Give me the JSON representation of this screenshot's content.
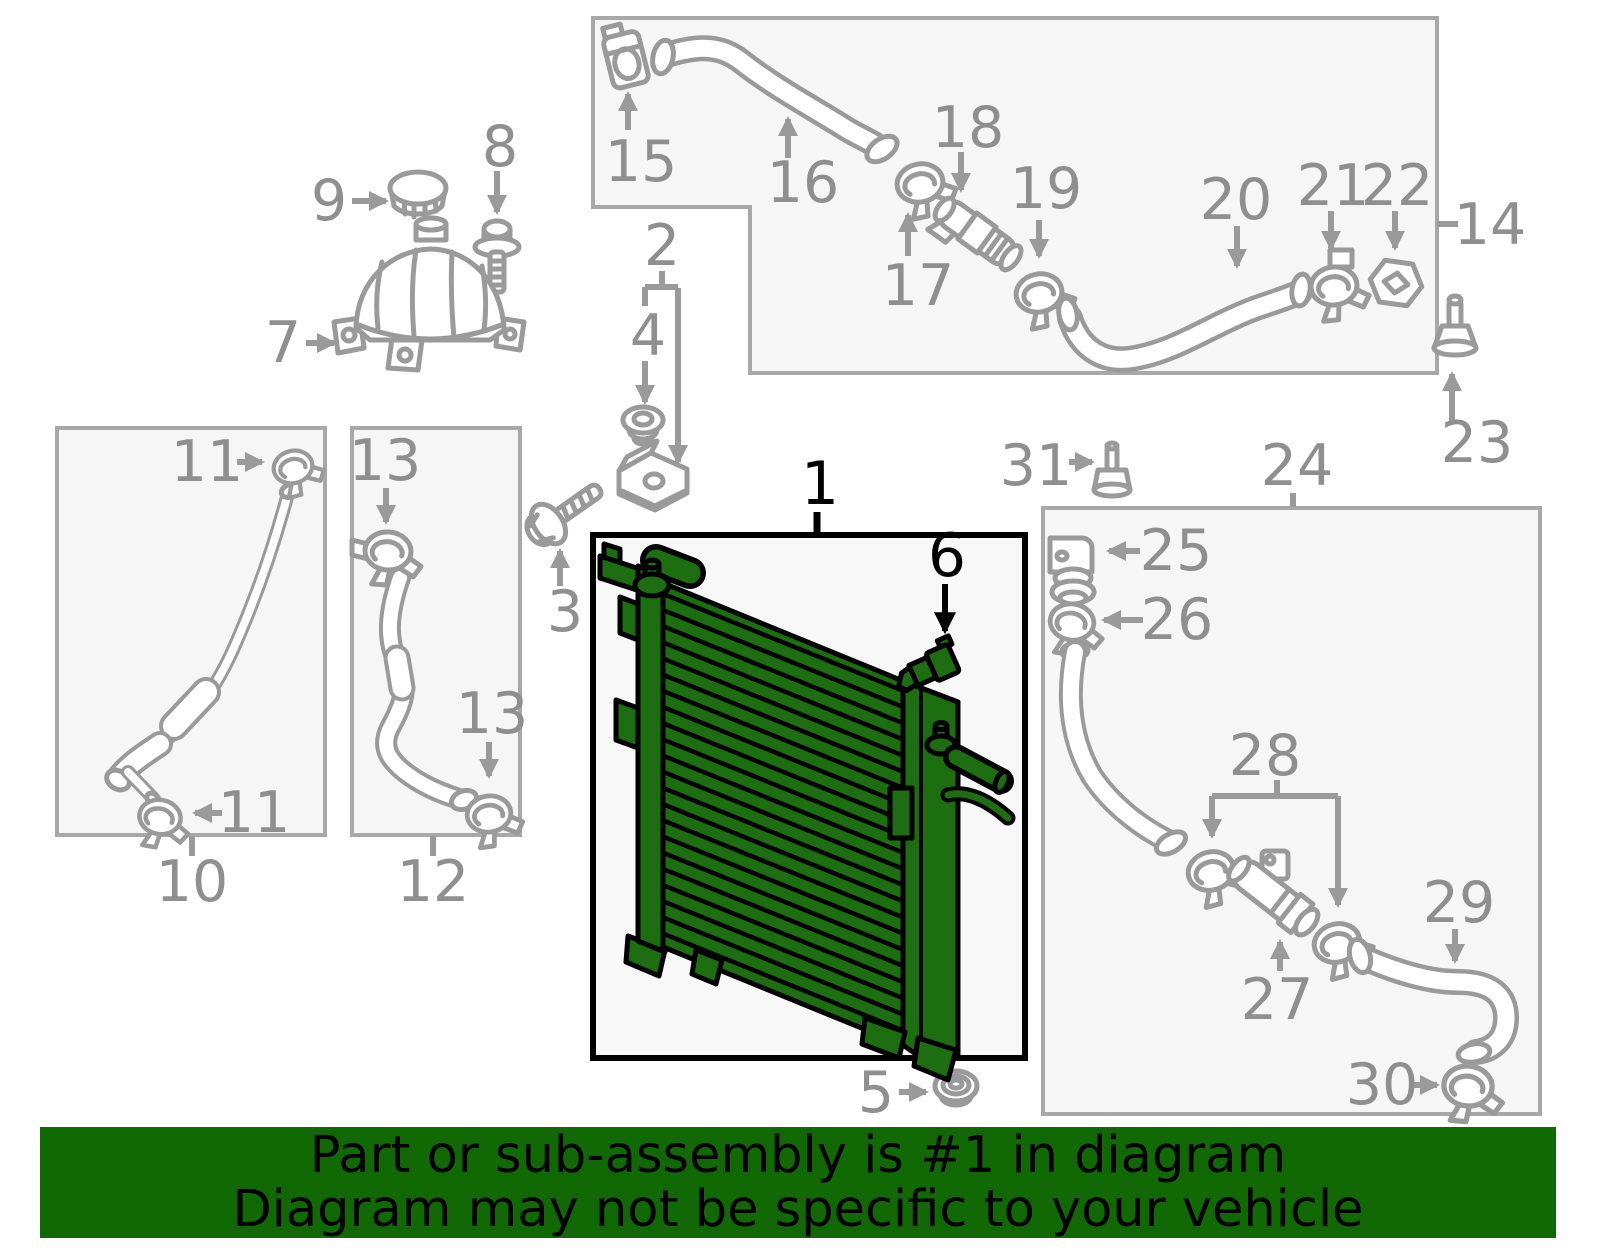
{
  "figure": {
    "kind": "oem-parts-diagram",
    "highlighted_callouts": [
      "1",
      "6"
    ]
  },
  "callouts": {
    "c1": "1",
    "c2": "2",
    "c3": "3",
    "c4": "4",
    "c5": "5",
    "c6": "6",
    "c7": "7",
    "c8": "8",
    "c9": "9",
    "c10": "10",
    "c11": "11",
    "c12": "12",
    "c13": "13",
    "c14": "14",
    "c15": "15",
    "c16": "16",
    "c17": "17",
    "c18": "18",
    "c19": "19",
    "c20": "20",
    "c21": "21",
    "c22": "22",
    "c23": "23",
    "c24": "24",
    "c25": "25",
    "c26": "26",
    "c27": "27",
    "c28": "28",
    "c29": "29",
    "c30": "30",
    "c31": "31"
  },
  "banner": {
    "line1": "Part or sub-assembly is #1 in diagram",
    "line2": "Diagram may not be specific to your vehicle"
  },
  "theme": {
    "highlight": "#1d6e10",
    "outline": "#000000",
    "line": "#9a9a9a",
    "label": "#8f8f8f",
    "box-fill": "#f6f6f6",
    "box-border": "#a8a8a8",
    "radiator-box-fill": "#f8f8f8",
    "banner-bg": "#116904",
    "banner-text": "#000000"
  }
}
